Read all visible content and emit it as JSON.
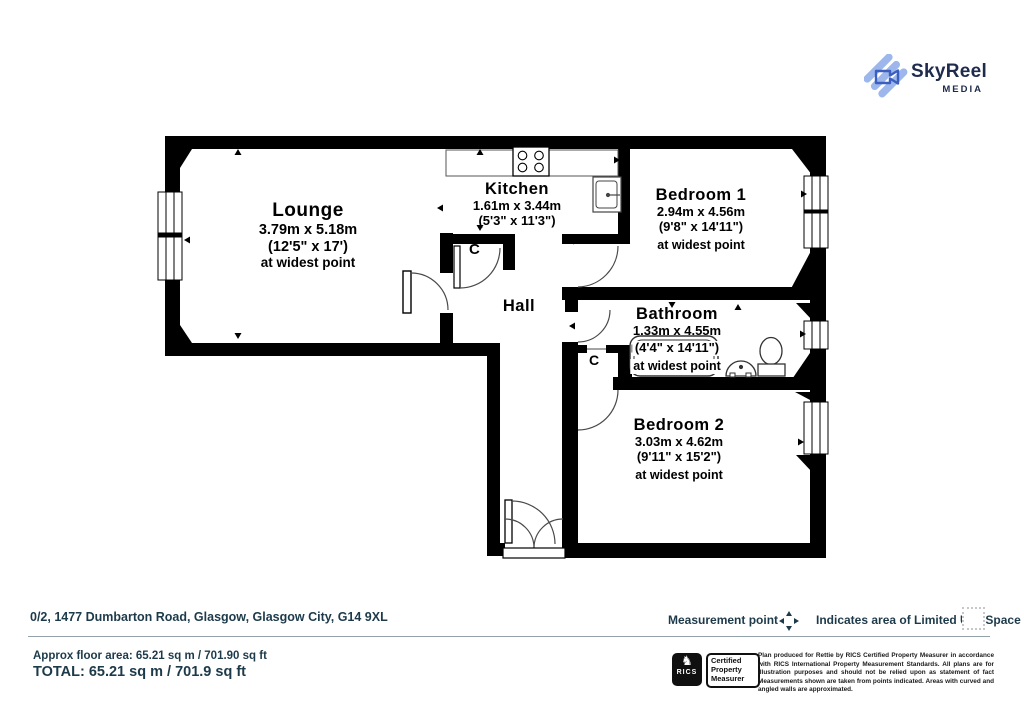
{
  "logo": {
    "name": "SkyReel",
    "sub": "MEDIA"
  },
  "rooms": {
    "lounge": {
      "name": "Lounge",
      "dims_m": "3.79m x 5.18m",
      "dims_ft": "(12'5\" x 17')",
      "note": "at widest point"
    },
    "kitchen": {
      "name": "Kitchen",
      "dims_m": "1.61m x 3.44m",
      "dims_ft": "(5'3\" x 11'3\")"
    },
    "bedroom1": {
      "name": "Bedroom 1",
      "dims_m": "2.94m x 4.56m",
      "dims_ft": "(9'8\" x 14'11\")",
      "note": "at widest point"
    },
    "bathroom": {
      "name": "Bathroom",
      "dims_m": "1.33m x 4.55m",
      "dims_ft": "(4'4\" x 14'11\")",
      "note": "at widest point"
    },
    "bedroom2": {
      "name": "Bedroom 2",
      "dims_m": "3.03m x 4.62m",
      "dims_ft": "(9'11\" x 15'2\")",
      "note": "at widest point"
    },
    "hall": {
      "name": "Hall"
    },
    "cupboard_label": "C"
  },
  "footer": {
    "address": "0/2, 1477 Dumbarton Road, Glasgow, Glasgow City, G14 9XL",
    "measurement_point_label": "Measurement point",
    "limited_use_label": "Indicates area of  Limited Use Space",
    "approx_area": "Approx floor area: 65.21 sq m / 701.90 sq ft",
    "total": "TOTAL: 65.21 sq m / 701.9 sq ft",
    "rics_label": "RICS",
    "certified": "Certified Property Measurer",
    "disclaimer": "Plan produced for Rettie by RICS Certified Property Measurer in accordance with RICS International Property  Measurement Standards.  All plans are for illustration purposes and should not be relied upon as statement of fact Measurements shown are taken from points indicated. Areas with curved and angled walls are approximated."
  },
  "colors": {
    "wall": "#000000",
    "accent_teal": "#1d3a4a",
    "logo_navy": "#1e2b4d",
    "logo_blue_light": "#9db7ec",
    "logo_blue_dark": "#3a5fc0"
  }
}
